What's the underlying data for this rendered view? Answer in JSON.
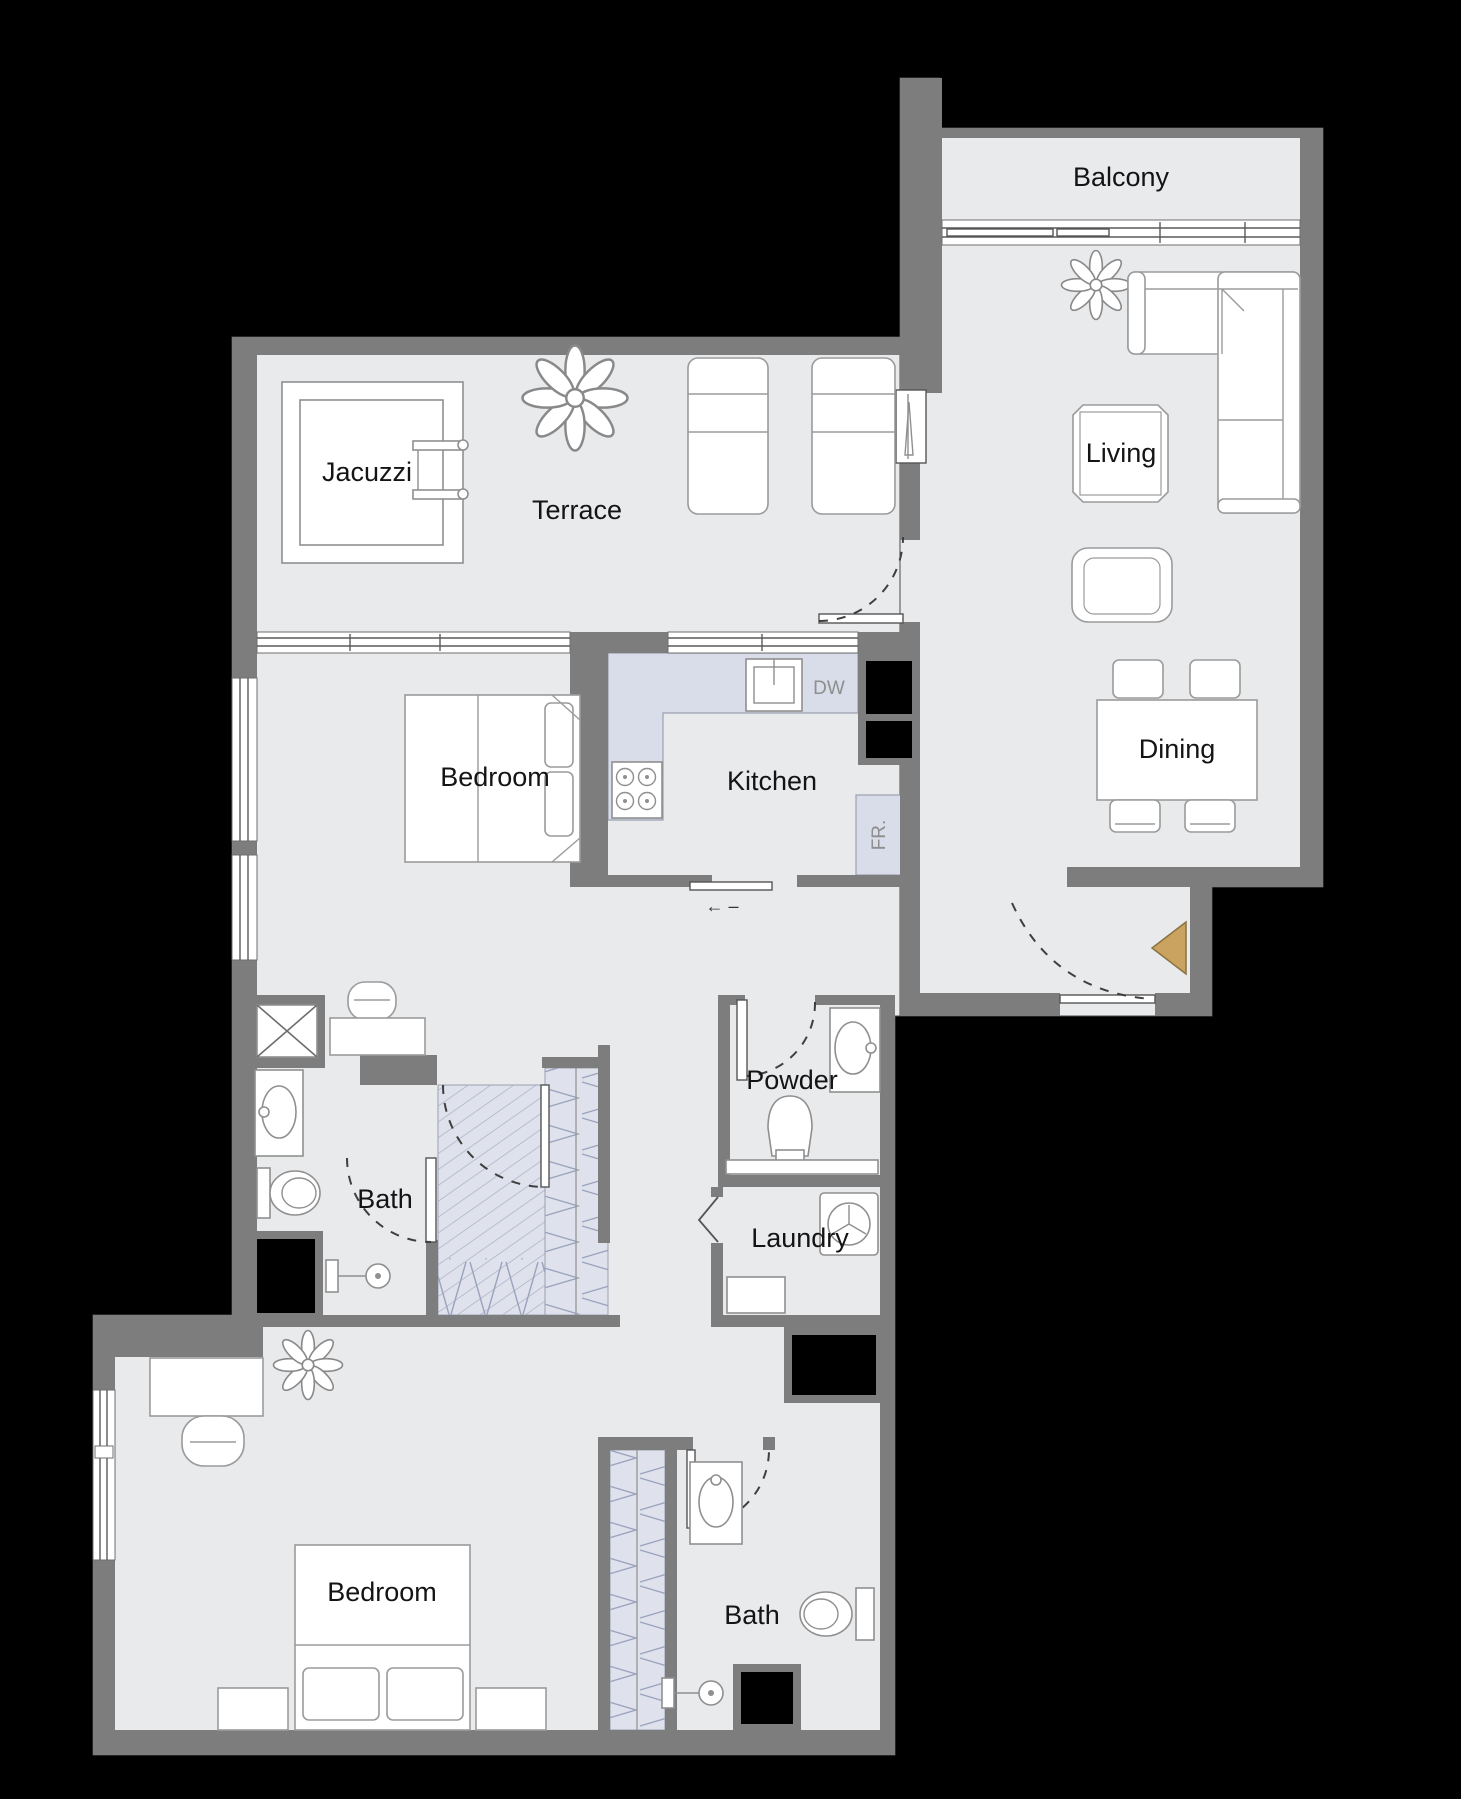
{
  "labels": {
    "balcony": "Balcony",
    "living": "Living",
    "terrace": "Terrace",
    "jacuzzi": "Jacuzzi",
    "bedroom_1": "Bedroom",
    "kitchen": "Kitchen",
    "dining": "Dining",
    "powder": "Powder",
    "bath_1": "Bath",
    "laundry": "Laundry",
    "bedroom_2": "Bedroom",
    "bath_2": "Bath",
    "dishwasher": "DW",
    "fridge": "FR.",
    "slide_arrow": "← –"
  },
  "colors": {
    "background": "#000000",
    "wall": "#7d7d7d",
    "floor": "#e9eaec",
    "counter": "#d9dde9",
    "closet_hatch": "#dfe2ec",
    "entry_marker": "#c9a35f",
    "label_text": "#141414",
    "appliance_text": "#8e8e8e"
  }
}
